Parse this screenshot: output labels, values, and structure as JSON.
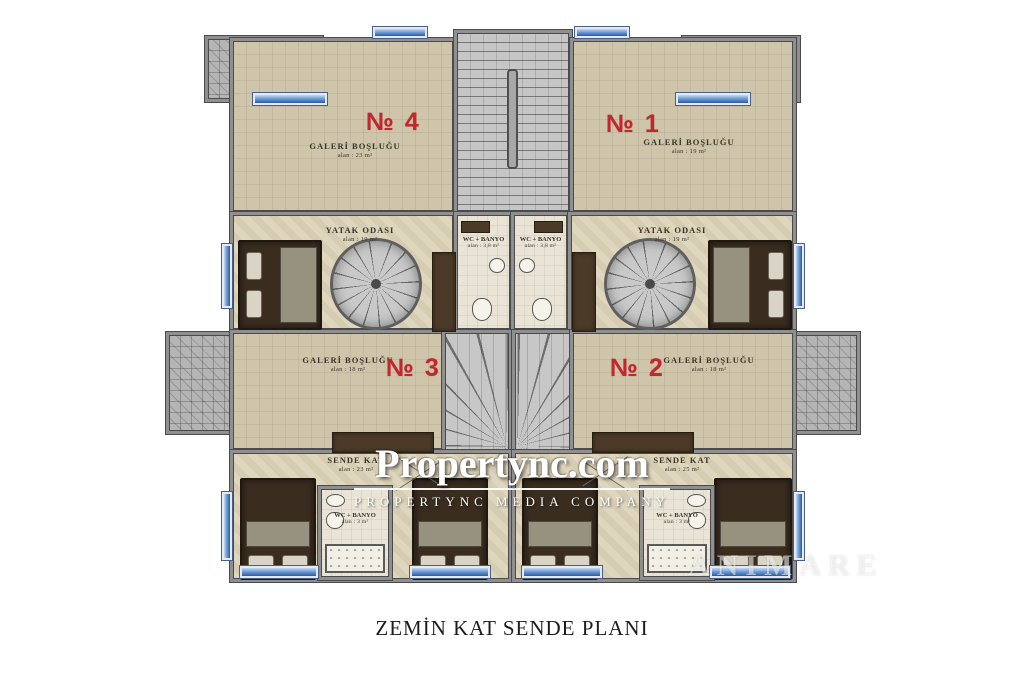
{
  "page": {
    "caption": "ZEMİN KAT SENDE PLANI"
  },
  "watermark": {
    "brand": "Propertync.com",
    "tagline": "PROPERTYNC MEDIA COMPANY",
    "corner": "ANIMARE"
  },
  "colors": {
    "unit_number_red": "#c1272d",
    "floor_beige": "#ddd3b9",
    "gallery_beige": "#cfc5ab",
    "tile_gray": "#b5b5b5",
    "wall_gray": "#8f8f8f",
    "glass_blue": "#2b5aa5",
    "furniture_brown": "#3a2d20"
  },
  "units": [
    {
      "number": "№ 4"
    },
    {
      "number": "№ 1"
    },
    {
      "number": "№ 3"
    },
    {
      "number": "№ 2"
    }
  ],
  "rooms": {
    "galeri4": {
      "name": "GALERİ BOŞLUĞU",
      "area": "alan : 23 m²"
    },
    "galeri1": {
      "name": "GALERİ BOŞLUĞU",
      "area": "alan : 19 m²"
    },
    "yatak_left": {
      "name": "YATAK ODASI",
      "area": "alan : 19 m²"
    },
    "yatak_right": {
      "name": "YATAK ODASI",
      "area": "alan : 19 m²"
    },
    "wc_mid_left": {
      "name": "WC + BANYO",
      "area": "alan : 3,8 m²"
    },
    "wc_mid_right": {
      "name": "WC + BANYO",
      "area": "alan : 3,8 m²"
    },
    "galeri3": {
      "name": "GALERİ BOŞLUĞU",
      "area": "alan : 18 m²"
    },
    "galeri2": {
      "name": "GALERİ BOŞLUĞU",
      "area": "alan : 18 m²"
    },
    "sende_left": {
      "name": "SENDE KAT",
      "area": "alan : 23 m²"
    },
    "sende_right": {
      "name": "SENDE KAT",
      "area": "alan : 25 m²"
    },
    "wc_bottom_left": {
      "name": "WC + BANYO",
      "area": "alan : 3 m²"
    },
    "wc_bottom_right": {
      "name": "WC + BANYO",
      "area": "alan : 3 m²"
    }
  }
}
